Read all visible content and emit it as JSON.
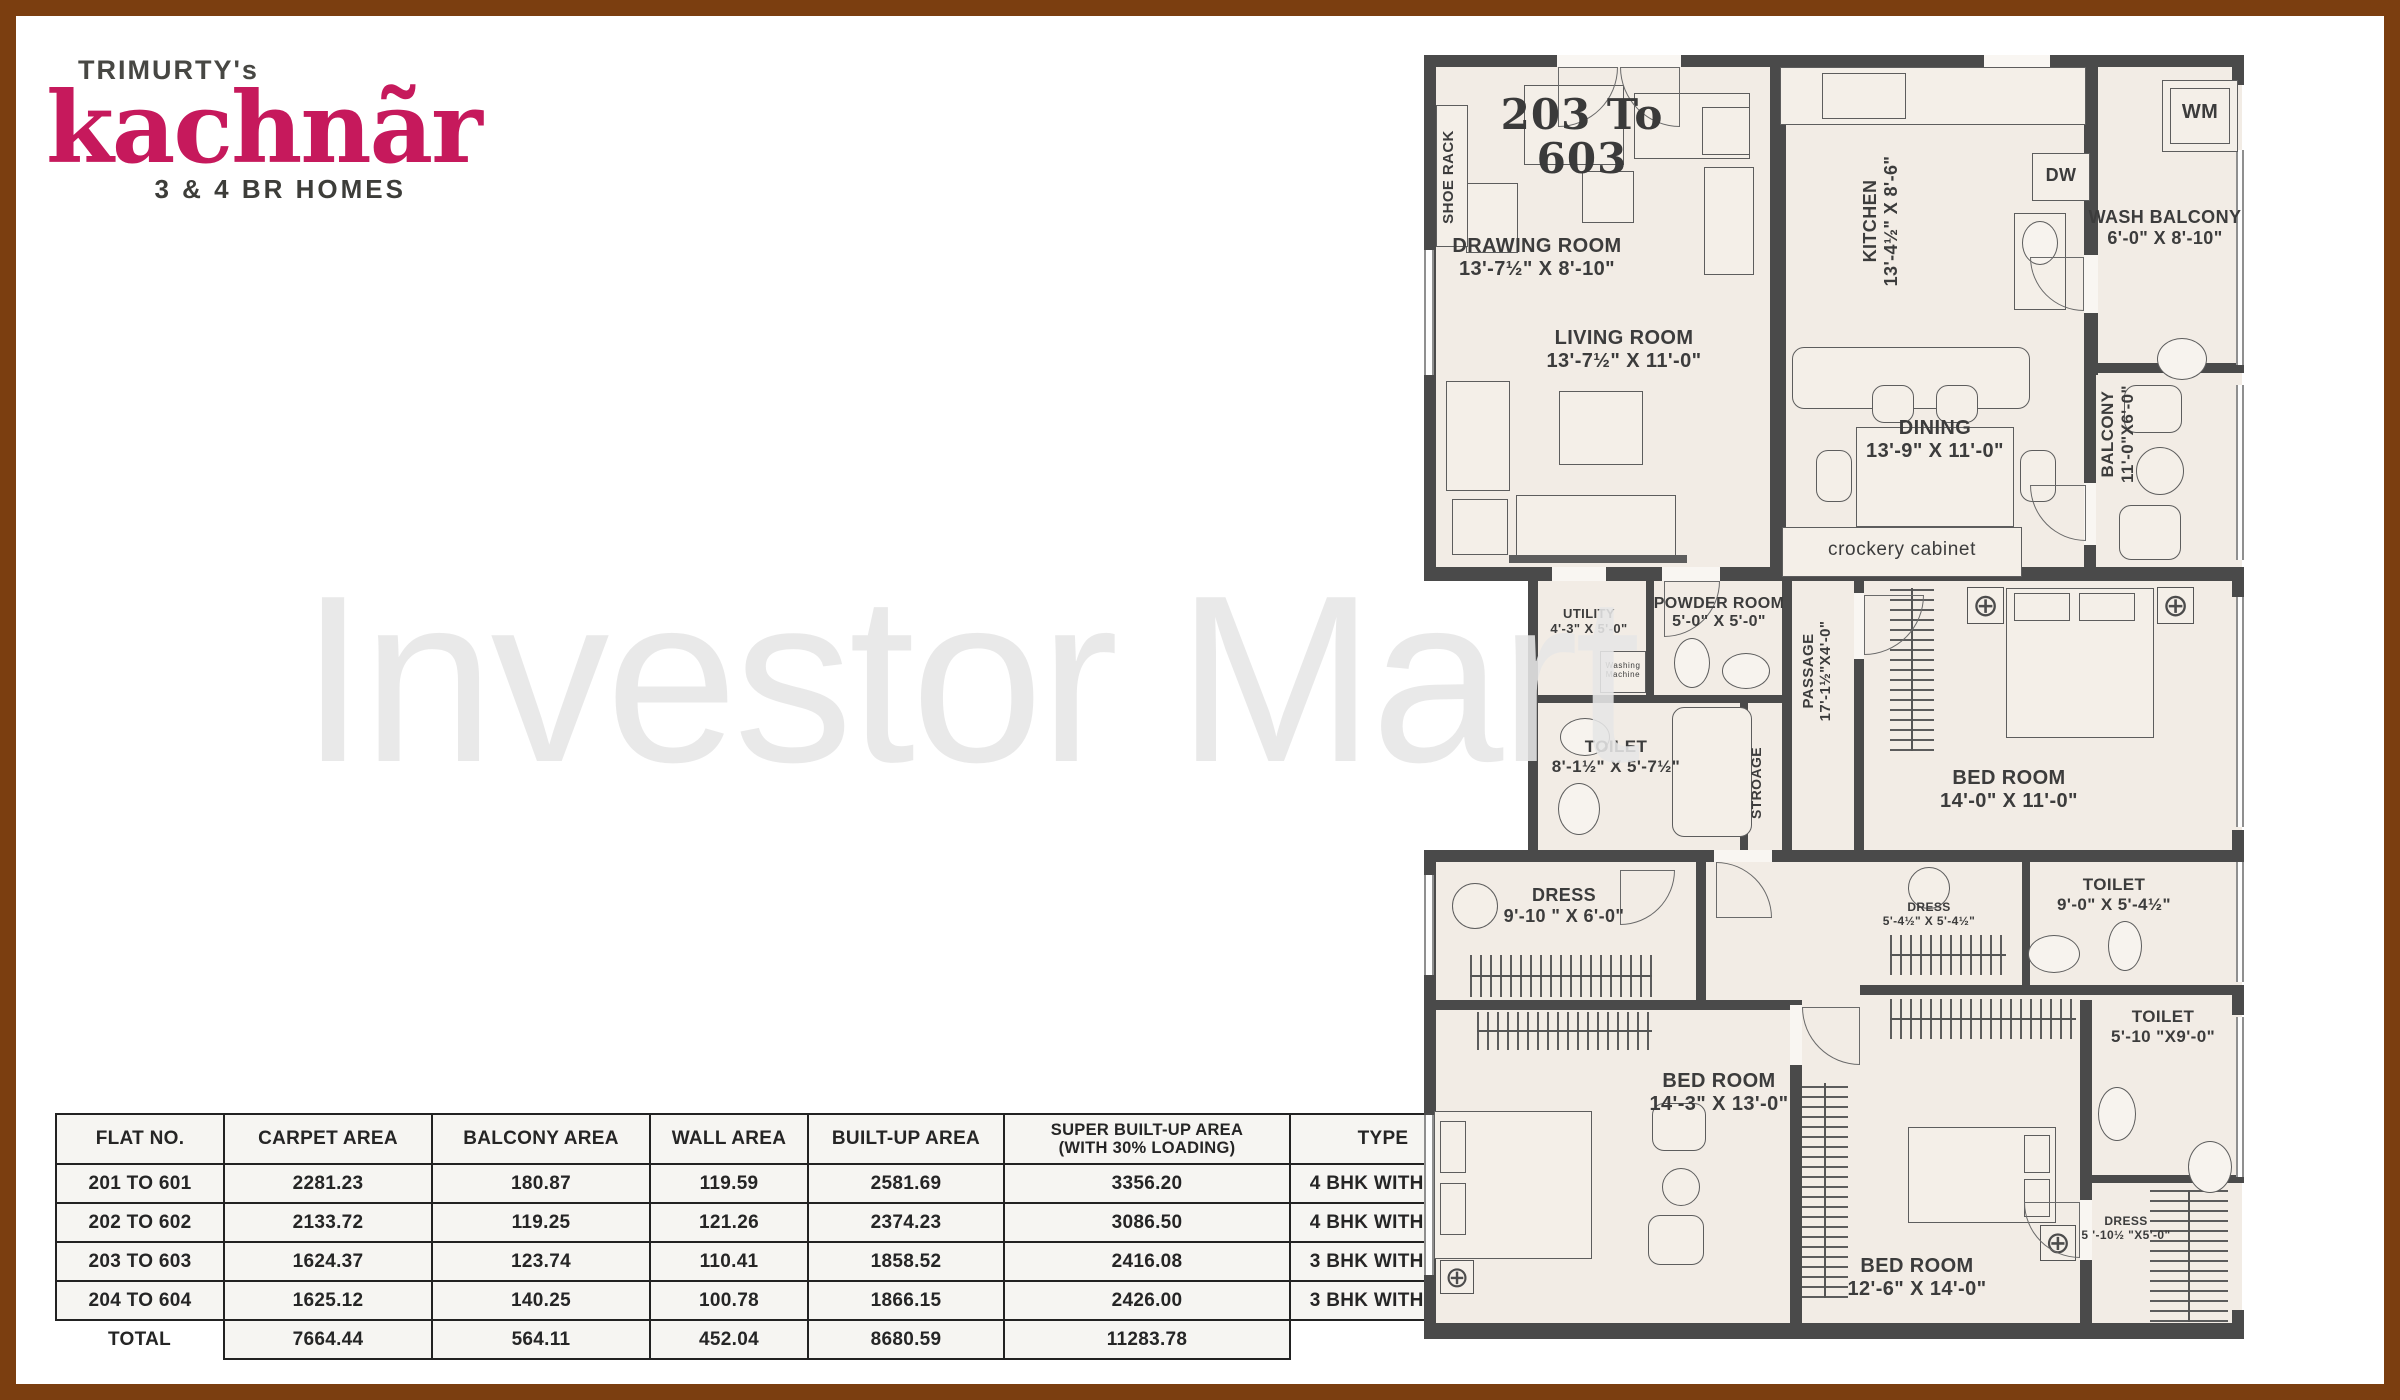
{
  "logo": {
    "brand_prefix": "TRIMURTY's",
    "brand_name": "kachnãr",
    "tagline": "3 & 4 BR HOMES",
    "brand_color": "#c6195c"
  },
  "watermark": "Investor Mart",
  "table": {
    "headers": [
      "FLAT NO.",
      "CARPET AREA",
      "BALCONY AREA",
      "WALL AREA",
      "BUILT-UP AREA",
      "SUPER BUILT-UP AREA\n(WITH 30% LOADING)",
      "TYPE"
    ],
    "col_widths": [
      150,
      190,
      200,
      140,
      178,
      268,
      168
    ],
    "rows": [
      [
        "201 TO 601",
        "2281.23",
        "180.87",
        "119.59",
        "2581.69",
        "3356.20",
        "4 BHK WITH SR"
      ],
      [
        "202 TO 602",
        "2133.72",
        "119.25",
        "121.26",
        "2374.23",
        "3086.50",
        "4 BHK WITH SR"
      ],
      [
        "203 TO 603",
        "1624.37",
        "123.74",
        "110.41",
        "1858.52",
        "2416.08",
        "3 BHK WITH SR"
      ],
      [
        "204 TO 604",
        "1625.12",
        "140.25",
        "100.78",
        "1866.15",
        "2426.00",
        "3 BHK WITH SR"
      ]
    ],
    "total_row": [
      "TOTAL",
      "7664.44",
      "564.11",
      "452.04",
      "8680.59",
      "11283.78",
      ""
    ]
  },
  "plan": {
    "unit_label": "203 To\n603",
    "fills": [
      [
        4,
        4,
        814,
        510
      ],
      [
        104,
        514,
        714,
        285
      ],
      [
        4,
        797,
        814,
        487
      ]
    ],
    "walls": [
      [
        0,
        0,
        820,
        12
      ],
      [
        0,
        512,
        671,
        14
      ],
      [
        660,
        512,
        160,
        14
      ],
      [
        0,
        795,
        820,
        12
      ],
      [
        0,
        945,
        376,
        10
      ],
      [
        436,
        930,
        384,
        10
      ],
      [
        660,
        1120,
        160,
        8
      ],
      [
        0,
        1268,
        820,
        16
      ],
      [
        0,
        0,
        12,
        520
      ],
      [
        104,
        512,
        10,
        295
      ],
      [
        0,
        795,
        12,
        487
      ],
      [
        346,
        0,
        16,
        260
      ],
      [
        346,
        260,
        16,
        252
      ],
      [
        660,
        0,
        14,
        200
      ],
      [
        660,
        258,
        14,
        62
      ],
      [
        660,
        308,
        160,
        10
      ],
      [
        660,
        318,
        12,
        194
      ],
      [
        222,
        525,
        8,
        118
      ],
      [
        358,
        525,
        10,
        270
      ],
      [
        430,
        525,
        10,
        270
      ],
      [
        316,
        645,
        8,
        150
      ],
      [
        104,
        640,
        262,
        8
      ],
      [
        272,
        795,
        10,
        150
      ],
      [
        366,
        945,
        12,
        335
      ],
      [
        598,
        795,
        8,
        137
      ],
      [
        656,
        945,
        12,
        335
      ],
      [
        808,
        0,
        12,
        30
      ],
      [
        808,
        512,
        12,
        30
      ],
      [
        808,
        775,
        12,
        32
      ],
      [
        808,
        930,
        12,
        30
      ],
      [
        808,
        1255,
        12,
        29
      ]
    ],
    "gaps": [
      [
        133,
        0,
        124,
        12
      ],
      [
        560,
        0,
        66,
        12
      ],
      [
        660,
        200,
        14,
        58
      ],
      [
        660,
        428,
        12,
        62
      ],
      [
        430,
        538,
        10,
        66
      ],
      [
        238,
        512,
        58,
        14
      ],
      [
        128,
        512,
        54,
        14
      ],
      [
        290,
        795,
        58,
        12
      ],
      [
        366,
        950,
        12,
        60
      ],
      [
        656,
        1145,
        12,
        60
      ]
    ],
    "windows": [
      [
        812,
        95,
        8,
        215
      ],
      [
        812,
        330,
        8,
        175
      ],
      [
        812,
        542,
        8,
        230
      ],
      [
        812,
        807,
        8,
        120
      ],
      [
        812,
        962,
        8,
        160
      ],
      [
        0,
        195,
        10,
        125
      ],
      [
        0,
        820,
        10,
        100
      ],
      [
        0,
        1060,
        10,
        160
      ]
    ],
    "hatches": [
      {
        "d": "v",
        "x": 466,
        "y": 533,
        "w": 44,
        "h": 163
      },
      {
        "d": "h",
        "x": 46,
        "y": 900,
        "w": 182,
        "h": 42
      },
      {
        "d": "h",
        "x": 53,
        "y": 957,
        "w": 175,
        "h": 38
      },
      {
        "d": "v",
        "x": 378,
        "y": 1028,
        "w": 46,
        "h": 215
      },
      {
        "d": "h",
        "x": 466,
        "y": 880,
        "w": 116,
        "h": 40
      },
      {
        "d": "h",
        "x": 466,
        "y": 944,
        "w": 186,
        "h": 40
      },
      {
        "d": "v",
        "x": 726,
        "y": 1135,
        "w": 78,
        "h": 132
      }
    ],
    "furniture": [
      {
        "t": "rect",
        "x": 100,
        "y": 30,
        "w": 100,
        "h": 80
      },
      {
        "t": "rect",
        "x": 42,
        "y": 128,
        "w": 52,
        "h": 70
      },
      {
        "t": "rect",
        "x": 158,
        "y": 116,
        "w": 52,
        "h": 52
      },
      {
        "t": "rect",
        "x": 210,
        "y": 38,
        "w": 116,
        "h": 66
      },
      {
        "t": "rect",
        "x": 278,
        "y": 52,
        "w": 48,
        "h": 48
      },
      {
        "t": "rect",
        "x": 280,
        "y": 112,
        "w": 50,
        "h": 108
      },
      {
        "t": "rect",
        "x": 135,
        "y": 336,
        "w": 84,
        "h": 74
      },
      {
        "t": "rect",
        "x": 22,
        "y": 326,
        "w": 64,
        "h": 110
      },
      {
        "t": "rect",
        "x": 92,
        "y": 440,
        "w": 160,
        "h": 62
      },
      {
        "t": "rect",
        "x": 28,
        "y": 444,
        "w": 56,
        "h": 56
      },
      {
        "t": "line",
        "x": 85,
        "y": 500,
        "w": 178,
        "h": 8
      },
      {
        "t": "rect",
        "x": 356,
        "y": 12,
        "w": 306,
        "h": 58
      },
      {
        "t": "rect",
        "x": 398,
        "y": 18,
        "w": 84,
        "h": 46
      },
      {
        "t": "rect",
        "x": 590,
        "y": 158,
        "w": 52,
        "h": 97
      },
      {
        "t": "ellipse",
        "x": 598,
        "y": 166,
        "w": 36,
        "h": 44
      },
      {
        "t": "rrect",
        "x": 368,
        "y": 292,
        "w": 238,
        "h": 62
      },
      {
        "t": "rect",
        "x": 432,
        "y": 372,
        "w": 158,
        "h": 100
      },
      {
        "t": "rrect",
        "x": 448,
        "y": 330,
        "w": 42,
        "h": 38
      },
      {
        "t": "rrect",
        "x": 512,
        "y": 330,
        "w": 42,
        "h": 38
      },
      {
        "t": "rrect",
        "x": 448,
        "y": 476,
        "w": 42,
        "h": 38
      },
      {
        "t": "rrect",
        "x": 512,
        "y": 476,
        "w": 42,
        "h": 38
      },
      {
        "t": "rrect",
        "x": 392,
        "y": 395,
        "w": 36,
        "h": 52
      },
      {
        "t": "rrect",
        "x": 596,
        "y": 395,
        "w": 36,
        "h": 52
      },
      {
        "t": "rect",
        "x": 358,
        "y": 472,
        "w": 240,
        "h": 50
      },
      {
        "t": "rrect",
        "x": 700,
        "y": 330,
        "w": 58,
        "h": 48
      },
      {
        "t": "circle",
        "x": 712,
        "y": 392,
        "w": 48,
        "h": 48
      },
      {
        "t": "rrect",
        "x": 695,
        "y": 450,
        "w": 62,
        "h": 55
      },
      {
        "t": "ellipse",
        "x": 733,
        "y": 283,
        "w": 50,
        "h": 42
      },
      {
        "t": "rect",
        "x": 738,
        "y": 25,
        "w": 76,
        "h": 72
      },
      {
        "t": "rect",
        "x": 746,
        "y": 33,
        "w": 60,
        "h": 56
      },
      {
        "t": "rect",
        "x": 608,
        "y": 98,
        "w": 58,
        "h": 48
      },
      {
        "t": "rect",
        "x": 12,
        "y": 50,
        "w": 32,
        "h": 142
      },
      {
        "t": "rect",
        "x": 176,
        "y": 596,
        "w": 46,
        "h": 42
      },
      {
        "t": "ellipse",
        "x": 250,
        "y": 583,
        "w": 36,
        "h": 50
      },
      {
        "t": "ellipse",
        "x": 298,
        "y": 598,
        "w": 48,
        "h": 36
      },
      {
        "t": "rrect",
        "x": 248,
        "y": 652,
        "w": 80,
        "h": 130
      },
      {
        "t": "ellipse",
        "x": 136,
        "y": 663,
        "w": 50,
        "h": 38
      },
      {
        "t": "ellipse",
        "x": 134,
        "y": 728,
        "w": 42,
        "h": 52
      },
      {
        "t": "rect",
        "x": 582,
        "y": 533,
        "w": 148,
        "h": 150
      },
      {
        "t": "rect",
        "x": 590,
        "y": 538,
        "w": 56,
        "h": 28
      },
      {
        "t": "rect",
        "x": 655,
        "y": 538,
        "w": 56,
        "h": 28
      },
      {
        "t": "fan",
        "x": 543,
        "y": 532,
        "w": 37,
        "h": 37
      },
      {
        "t": "fan",
        "x": 733,
        "y": 532,
        "w": 37,
        "h": 37
      },
      {
        "t": "circle",
        "x": 28,
        "y": 828,
        "w": 46,
        "h": 46
      },
      {
        "t": "rect",
        "x": 10,
        "y": 1056,
        "w": 158,
        "h": 148
      },
      {
        "t": "rect",
        "x": 16,
        "y": 1066,
        "w": 26,
        "h": 52
      },
      {
        "t": "rect",
        "x": 16,
        "y": 1128,
        "w": 26,
        "h": 52
      },
      {
        "t": "rrect",
        "x": 228,
        "y": 1048,
        "w": 54,
        "h": 48
      },
      {
        "t": "circle",
        "x": 238,
        "y": 1113,
        "w": 38,
        "h": 38
      },
      {
        "t": "rrect",
        "x": 224,
        "y": 1160,
        "w": 56,
        "h": 50
      },
      {
        "t": "fan",
        "x": 16,
        "y": 1205,
        "w": 34,
        "h": 34
      },
      {
        "t": "rect",
        "x": 484,
        "y": 1072,
        "w": 148,
        "h": 96
      },
      {
        "t": "rect",
        "x": 600,
        "y": 1080,
        "w": 26,
        "h": 38
      },
      {
        "t": "rect",
        "x": 600,
        "y": 1124,
        "w": 26,
        "h": 38
      },
      {
        "t": "fan",
        "x": 616,
        "y": 1170,
        "w": 36,
        "h": 36
      },
      {
        "t": "ellipse",
        "x": 684,
        "y": 866,
        "w": 34,
        "h": 50
      },
      {
        "t": "ellipse",
        "x": 604,
        "y": 880,
        "w": 52,
        "h": 38
      },
      {
        "t": "circle",
        "x": 484,
        "y": 812,
        "w": 42,
        "h": 42
      },
      {
        "t": "ellipse",
        "x": 674,
        "y": 1032,
        "w": 38,
        "h": 54
      },
      {
        "t": "ellipse",
        "x": 764,
        "y": 1086,
        "w": 44,
        "h": 52
      },
      {
        "t": "arc",
        "c": "tl",
        "x": 134,
        "y": 12,
        "w": 60,
        "h": 60
      },
      {
        "t": "arc",
        "c": "tr",
        "x": 196,
        "y": 12,
        "w": 60,
        "h": 60
      },
      {
        "t": "arc",
        "c": "tl",
        "x": 240,
        "y": 526,
        "w": 56,
        "h": 56
      },
      {
        "t": "arc",
        "c": "tr",
        "x": 606,
        "y": 202,
        "w": 54,
        "h": 54
      },
      {
        "t": "arc",
        "c": "tr",
        "x": 606,
        "y": 430,
        "w": 56,
        "h": 56
      },
      {
        "t": "arc",
        "c": "tl",
        "x": 440,
        "y": 540,
        "w": 60,
        "h": 60
      },
      {
        "t": "arc",
        "c": "bl",
        "x": 292,
        "y": 807,
        "w": 56,
        "h": 56
      },
      {
        "t": "arc",
        "c": "tl",
        "x": 196,
        "y": 815,
        "w": 55,
        "h": 55
      },
      {
        "t": "arc",
        "c": "tr",
        "x": 378,
        "y": 952,
        "w": 58,
        "h": 58
      },
      {
        "t": "arc",
        "c": "tr",
        "x": 600,
        "y": 1147,
        "w": 56,
        "h": 56
      }
    ],
    "labels": [
      {
        "id": "unit-number",
        "text": "203 To\n603",
        "x": 48,
        "y": 38,
        "w": 220,
        "size": 42,
        "serif": true
      },
      {
        "id": "shoe-rack",
        "text": "SHOE RACK",
        "x": 16,
        "y": 52,
        "len": 140,
        "size": 15,
        "vert": true
      },
      {
        "id": "drawing-room",
        "text": "DRAWING ROOM\n13'-7½\" X 8'-10\"",
        "x": 8,
        "y": 180,
        "w": 210,
        "size": 20
      },
      {
        "id": "living-room",
        "text": "LIVING ROOM\n13'-7½\" X 11'-0\"",
        "x": 95,
        "y": 272,
        "w": 210,
        "size": 20
      },
      {
        "id": "kitchen",
        "text": "KITCHEN\n13'-4½\" X 8'-6\"",
        "x": 436,
        "y": 98,
        "len": 136,
        "size": 18,
        "vert": true
      },
      {
        "id": "dw",
        "text": "DW",
        "x": 608,
        "y": 110,
        "w": 58,
        "size": 18
      },
      {
        "id": "wm",
        "text": "WM",
        "x": 738,
        "y": 46,
        "w": 76,
        "size": 20
      },
      {
        "id": "wash-balcony",
        "text": "WASH BALCONY\n6'-0\" X 8'-10\"",
        "x": 662,
        "y": 152,
        "w": 158,
        "size": 18
      },
      {
        "id": "balcony",
        "text": "BALCONY\n11'-0\"X6'-0\"",
        "x": 674,
        "y": 318,
        "len": 122,
        "size": 17,
        "vert": true
      },
      {
        "id": "dining",
        "text": "DINING\n13'-9\" X 11'-0\"",
        "x": 418,
        "y": 362,
        "w": 186,
        "size": 20
      },
      {
        "id": "crockery-cabinet",
        "text": "crockery cabinet",
        "x": 362,
        "y": 484,
        "w": 232,
        "size": 19,
        "light": true
      },
      {
        "id": "utility",
        "text": "UTILITY\n4'-3\" X 5'-0\"",
        "x": 112,
        "y": 552,
        "w": 106,
        "size": 13
      },
      {
        "id": "powder-room",
        "text": "POWDER ROOM\n5'-0\" X 5'-0\"",
        "x": 226,
        "y": 540,
        "w": 138,
        "size": 16
      },
      {
        "id": "washing-machine",
        "text": "Washing\nMachine",
        "x": 178,
        "y": 606,
        "w": 42,
        "size": 8,
        "light": true
      },
      {
        "id": "passage",
        "text": "PASSAGE\n17'-1½\"X4'-0\"",
        "x": 376,
        "y": 550,
        "len": 132,
        "size": 15,
        "vert": true
      },
      {
        "id": "toilet-1",
        "text": "TOILET\n8'-1½\" X 5'-7½\"",
        "x": 112,
        "y": 682,
        "w": 160,
        "size": 17
      },
      {
        "id": "storage",
        "text": "STROAGE",
        "x": 324,
        "y": 682,
        "len": 92,
        "size": 14,
        "vert": true
      },
      {
        "id": "bed-room-1",
        "text": "BED ROOM\n14'-0\" X 11'-0\"",
        "x": 480,
        "y": 712,
        "w": 210,
        "size": 20
      },
      {
        "id": "dress-1",
        "text": "DRESS\n9'-10 \" X 6'-0\"",
        "x": 55,
        "y": 830,
        "w": 170,
        "size": 18
      },
      {
        "id": "dress-2",
        "text": "DRESS\n5'-4½\" X 5'-4½\"",
        "x": 440,
        "y": 846,
        "w": 130,
        "size": 12
      },
      {
        "id": "toilet-2",
        "text": "TOILET\n9'-0\" X 5'-4½\"",
        "x": 610,
        "y": 820,
        "w": 160,
        "size": 17
      },
      {
        "id": "bed-room-2",
        "text": "BED ROOM\n14'-3\" X 13'-0\"",
        "x": 190,
        "y": 1015,
        "w": 210,
        "size": 20
      },
      {
        "id": "toilet-3",
        "text": "TOILET\n5'-10 \"X9'-0\"",
        "x": 664,
        "y": 952,
        "w": 150,
        "size": 17
      },
      {
        "id": "bed-room-3",
        "text": "BED ROOM\n12'-6\" X 14'-0\"",
        "x": 388,
        "y": 1200,
        "w": 210,
        "size": 20
      },
      {
        "id": "dress-3",
        "text": "DRESS\n5 '-10½ \"X5'-0\"",
        "x": 636,
        "y": 1160,
        "w": 132,
        "size": 12
      }
    ]
  }
}
